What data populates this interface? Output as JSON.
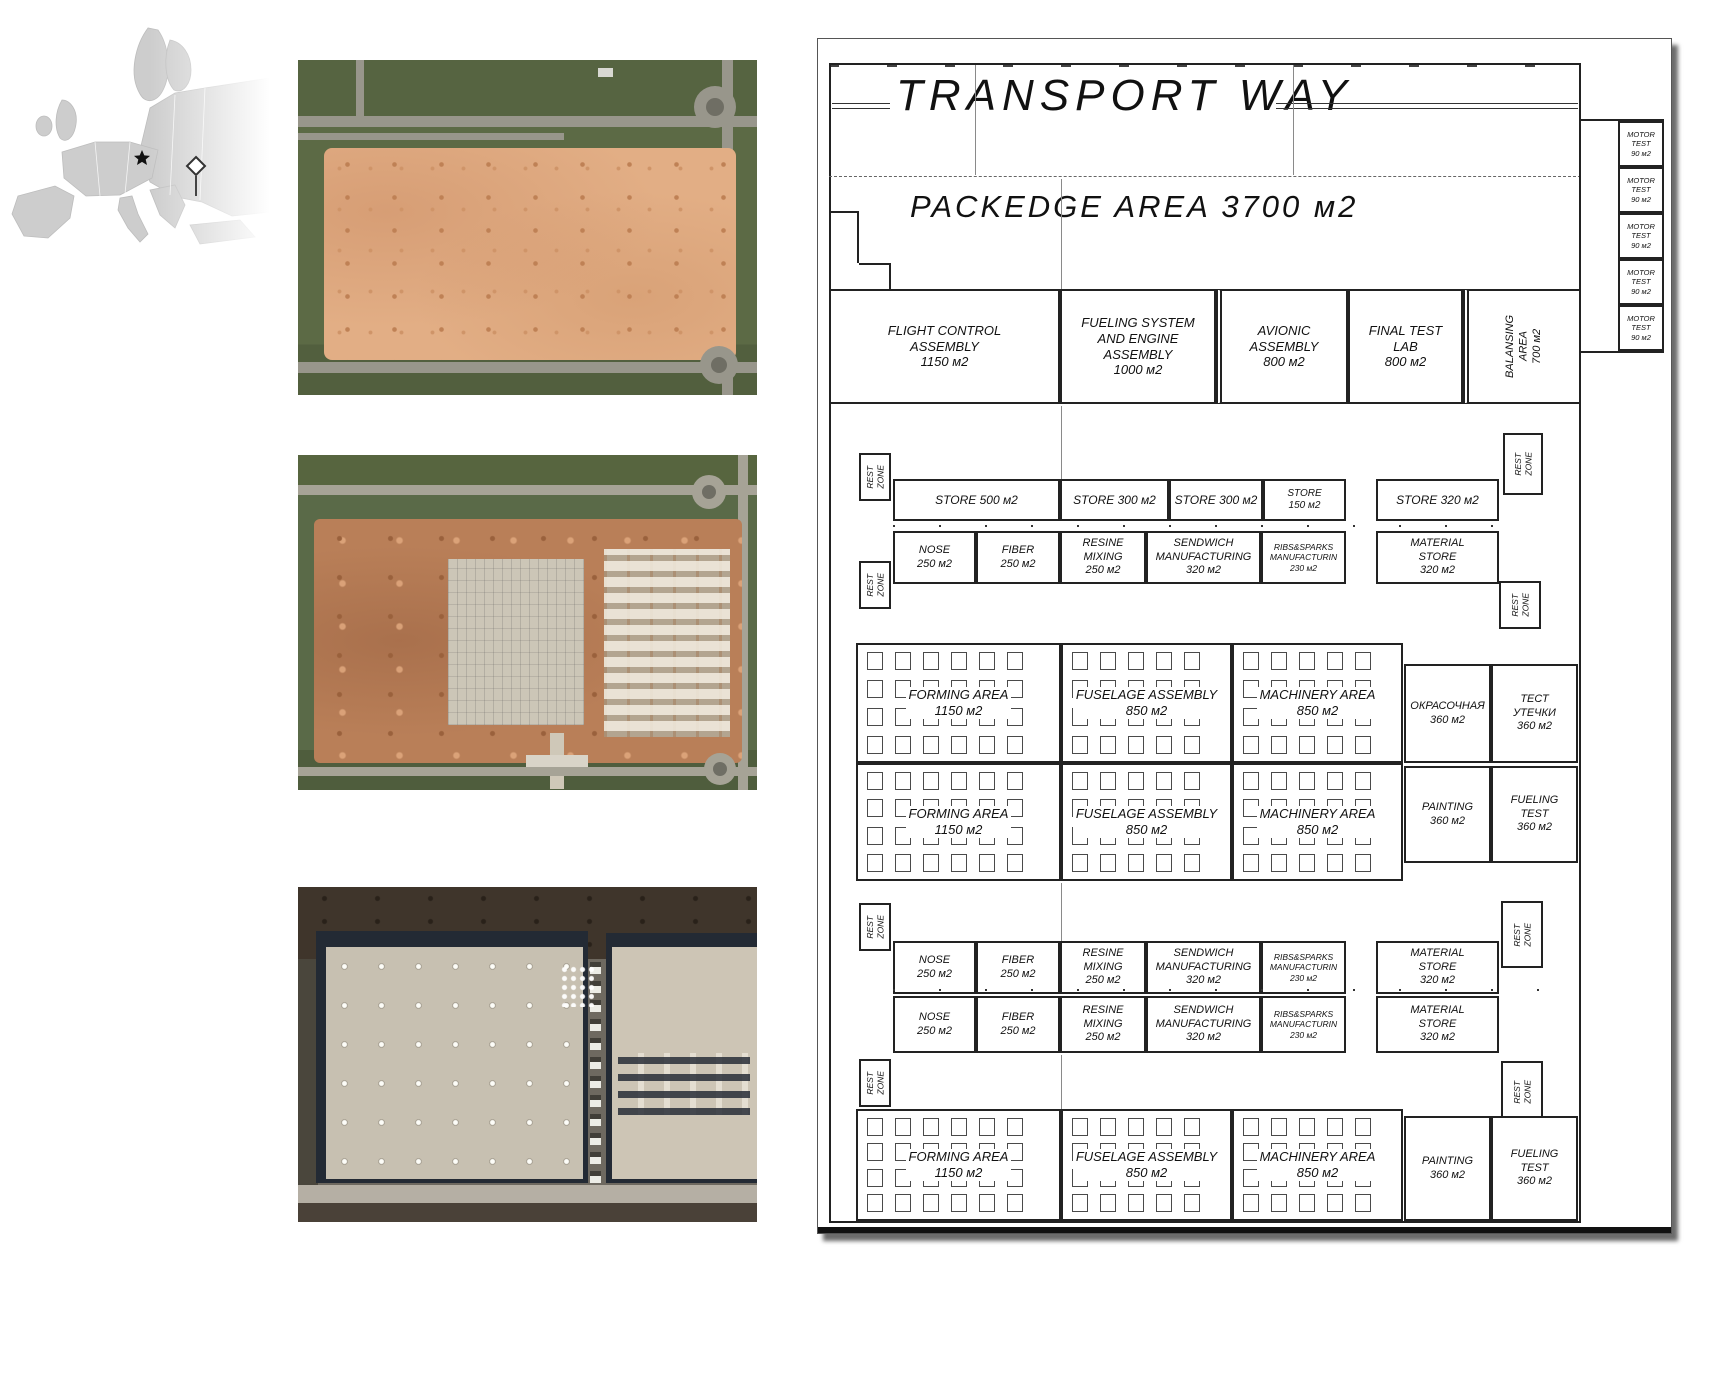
{
  "map": {
    "markers": [
      "star",
      "pin"
    ]
  },
  "plan": {
    "transport_way": "TRANSPORT WAY",
    "packedge_area": "PACKEDGE AREA 3700 м2",
    "assembly_rooms": [
      "FLIGHT CONTROL\nASSEMBLY\n1150 м2",
      "FUELING SYSTEM\nAND ENGINE\nASSEMBLY\n1000 м2",
      "AVIONIC\nASSEMBLY\n800 м2",
      "FINAL TEST\nLAB\n800 м2",
      "BALANSING\nAREA\n700 м2"
    ],
    "motor_test": "MOTOR\nTEST\n90 м2",
    "rest_zone": "REST\nZONE",
    "stores": [
      "STORE 500 м2",
      "STORE 300 м2",
      "STORE 300 м2",
      "STORE\n150 м2",
      "STORE 320 м2"
    ],
    "manufacturing": [
      "NOSE\n250 м2",
      "FIBER\n250 м2",
      "RESINE\nMIXING\n250 м2",
      "SENDWICH\nMANUFACTURING\n320 м2",
      "RIBS&SPARKS\nMANUFACTURIN\n230 м2",
      "MATERIAL\nSTORE\n320 м2"
    ],
    "production": [
      "FORMING AREA\n1150 м2",
      "FUSELAGE ASSEMBLY\n850 м2",
      "MACHINERY AREA\n850 м2"
    ],
    "finishing_row1": [
      "ОКРАСОЧНАЯ\n360 м2",
      "ТЕСТ\nУТЕЧКИ\n360 м2"
    ],
    "finishing_row2": [
      "PAINTING\n360 м2",
      "FUELING\nTEST\n360 м2"
    ]
  },
  "colors": {
    "plan_line": "#222222",
    "cleared_dirt": "#e2ae85",
    "construction_clay": "#b97f58",
    "grass": "#5a6a48",
    "road": "#98968b",
    "roof": "#c7c0b1",
    "building_edge": "#232a34",
    "map_land": "#cdcdcd"
  }
}
